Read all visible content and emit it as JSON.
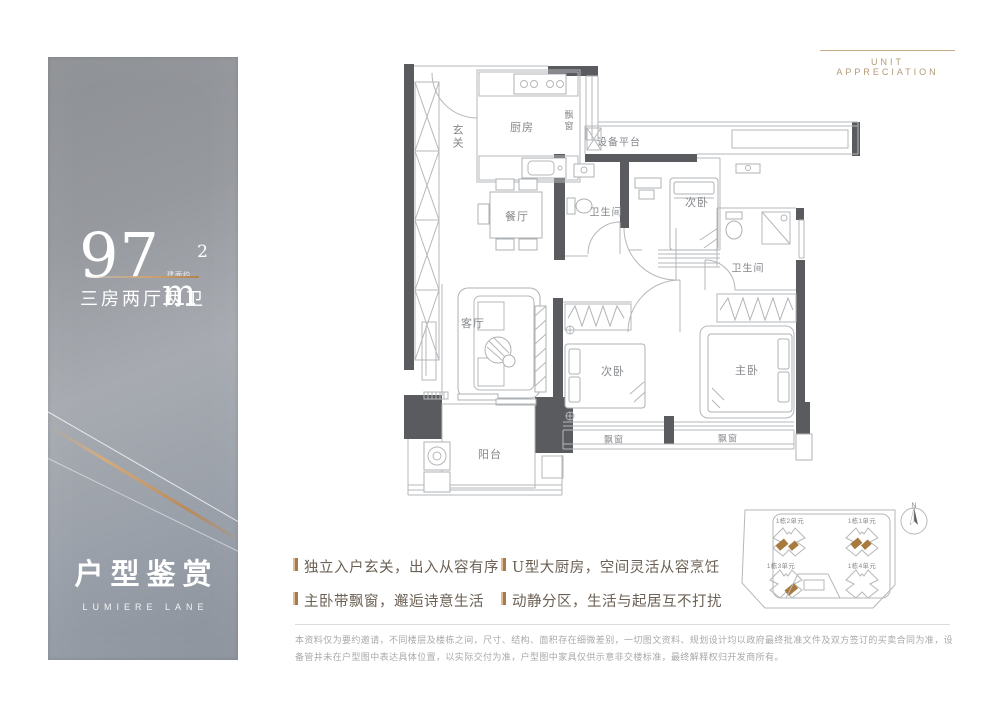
{
  "panel": {
    "area_prefix": "建面约",
    "area_value": "97",
    "area_unit": "m",
    "area_exp": "2",
    "layout_label": "三房两厅两卫",
    "title": "户型鉴赏",
    "subtitle": "LUMIERE LANE"
  },
  "header": {
    "tagline": "UNIT APPRECIATION"
  },
  "floorplan": {
    "labels": {
      "entry": "玄关",
      "kitchen": "厨房",
      "kitchen_bay": "飘窗",
      "equipment_platform": "设备平台",
      "bathroom1": "卫生间",
      "bathroom2": "卫生间",
      "bedroom_top": "次卧",
      "bedroom_mid": "次卧",
      "master_bedroom": "主卧",
      "living_room": "客厅",
      "dining_room": "餐厅",
      "balcony": "阳台",
      "bay_left": "飘窗",
      "bay_right": "飘窗"
    }
  },
  "features": {
    "items": [
      "独立入户玄关，出入从容有序",
      "U型大厨房，空间灵活从容烹饪",
      "主卧带飘窗，邂逅诗意生活",
      "动静分区，生活与起居互不打扰"
    ]
  },
  "siteplan": {
    "compass_label": "N",
    "units": [
      {
        "label": "1栋2单元"
      },
      {
        "label": "1栋1单元"
      },
      {
        "label": "1栋3单元"
      },
      {
        "label": "1栋4单元"
      }
    ]
  },
  "disclaimer": "本资料仅为要约邀请，不同楼层及楼栋之间，尺寸、结构、面积存在细微差别，一切图文资料、规划设计均以政府最终批准文件及双方签订的买卖合同为准，设备管井未在户型图中表达具体位置，以实际交付为准，户型图中家具仅供示意非交楼标准，最终解释权归开发商所有。",
  "colors": {
    "accent_gold": "#b58a5f",
    "wall_dark": "#5a5b5f",
    "line_light": "#b5b7ba",
    "label_gray": "#85878b",
    "feature_text": "#6b6054",
    "highlight_brown": "#a87a3e"
  }
}
